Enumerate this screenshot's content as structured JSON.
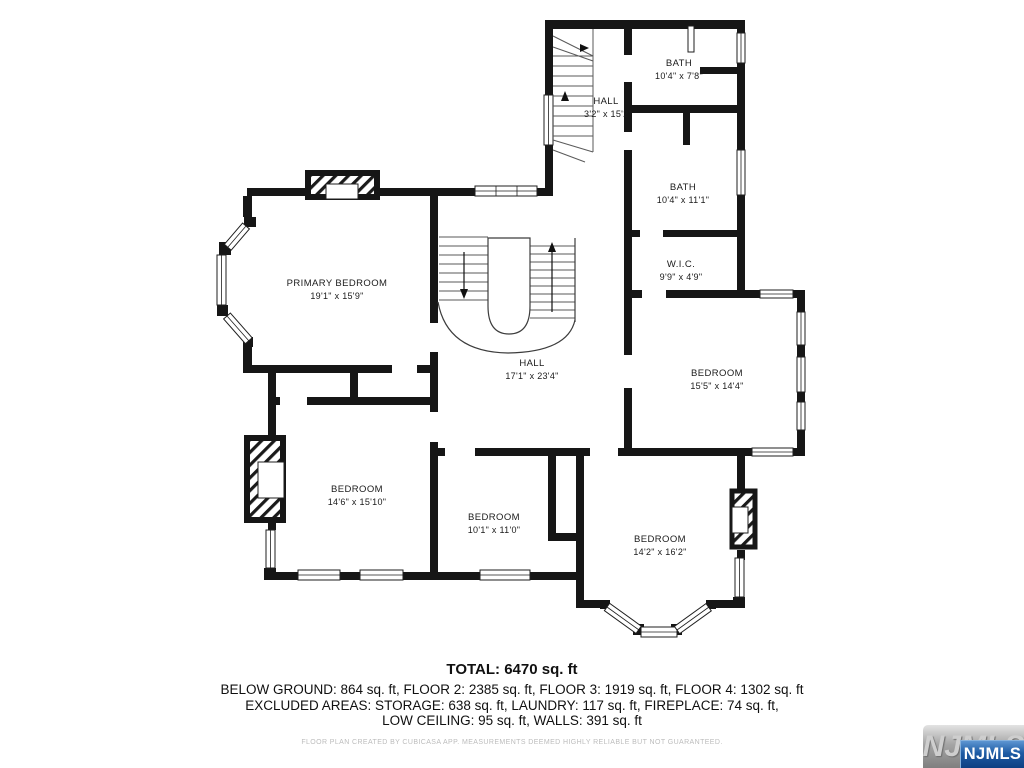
{
  "plan": {
    "rooms": [
      {
        "id": "bath-top",
        "name": "BATH",
        "dims": "10'4\" x 7'8\""
      },
      {
        "id": "hall-upper",
        "name": "HALL",
        "dims": "3'2\" x 15'2\""
      },
      {
        "id": "bath-mid",
        "name": "BATH",
        "dims": "10'4\" x 11'1\""
      },
      {
        "id": "wic",
        "name": "W.I.C.",
        "dims": "9'9\" x 4'9\""
      },
      {
        "id": "primary-bedroom",
        "name": "PRIMARY BEDROOM",
        "dims": "19'1\" x 15'9\""
      },
      {
        "id": "hall-main",
        "name": "HALL",
        "dims": "17'1\" x 23'4\""
      },
      {
        "id": "bedroom-right",
        "name": "BEDROOM",
        "dims": "15'5\" x 14'4\""
      },
      {
        "id": "bedroom-left",
        "name": "BEDROOM",
        "dims": "14'6\" x 15'10\""
      },
      {
        "id": "bedroom-center",
        "name": "BEDROOM",
        "dims": "10'1\" x 11'0\""
      },
      {
        "id": "bedroom-bay",
        "name": "BEDROOM",
        "dims": "14'2\" x 16'2\""
      }
    ],
    "wall_color": "#161616"
  },
  "footer": {
    "total": "TOTAL: 6470 sq. ft",
    "line1": "BELOW GROUND: 864 sq. ft, FLOOR 2: 2385 sq. ft, FLOOR 3: 1919 sq. ft, FLOOR 4: 1302 sq. ft",
    "line2": "EXCLUDED AREAS: STORAGE: 638 sq. ft, LAUNDRY: 117 sq. ft, FIREPLACE: 74 sq. ft,",
    "line3": "LOW CEILING: 95 sq. ft, WALLS: 391 sq. ft",
    "disclaimer": "FLOOR PLAN CREATED BY CUBICASA APP. MEASUREMENTS DEEMED HIGHLY RELIABLE BUT NOT GUARANTEED."
  },
  "logo": {
    "watermark": "NJMLS",
    "badge": "NJMLS",
    "badge_color": "#1d5ba4"
  }
}
